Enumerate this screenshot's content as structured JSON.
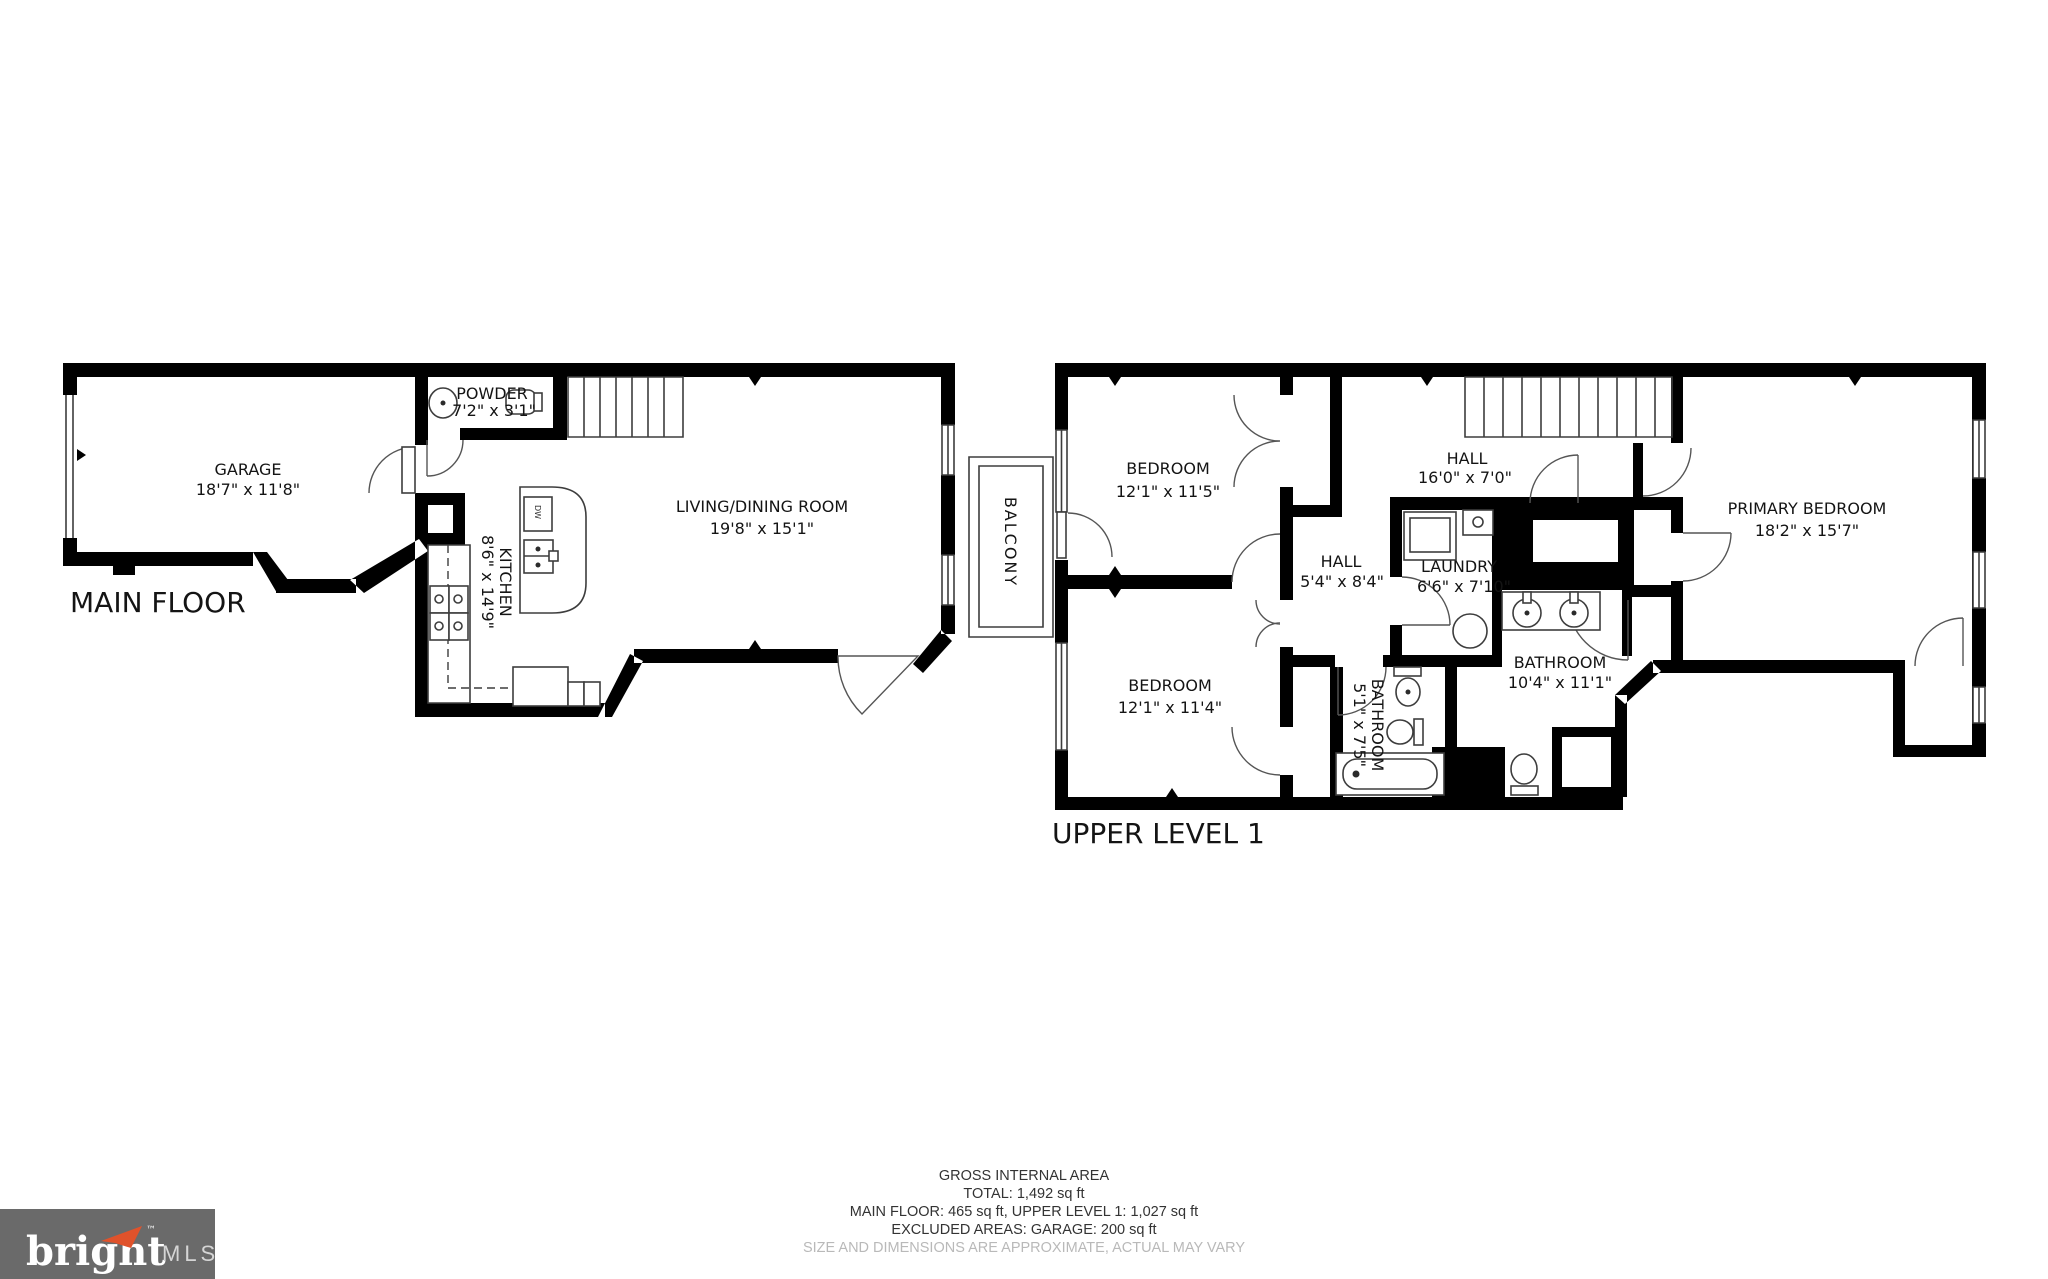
{
  "captions": {
    "main_floor": "MAIN FLOOR",
    "upper_level": "UPPER LEVEL 1"
  },
  "rooms": {
    "garage": {
      "name": "GARAGE",
      "dims": "18'7\" x 11'8\""
    },
    "powder": {
      "name": "POWDER",
      "dims": "7'2\" x 3'1\""
    },
    "kitchen": {
      "name": "KITCHEN",
      "dims": "8'6\" x 14'9\""
    },
    "living": {
      "name": "LIVING/DINING ROOM",
      "dims": "19'8\" x 15'1\""
    },
    "balcony": {
      "name": "BALCONY"
    },
    "bedroom1": {
      "name": "BEDROOM",
      "dims": "12'1\" x 11'5\""
    },
    "bedroom2": {
      "name": "BEDROOM",
      "dims": "12'1\" x 11'4\""
    },
    "hall_upper": {
      "name": "HALL",
      "dims": "16'0\" x 7'0\""
    },
    "hall_lower": {
      "name": "HALL",
      "dims": "5'4\" x 8'4\""
    },
    "laundry": {
      "name": "LAUNDRY",
      "dims": "6'6\" x 7'10\""
    },
    "bathroom_small": {
      "name": "BATHROOM",
      "dims": "5'1\" x 7'5\""
    },
    "bathroom_main": {
      "name": "BATHROOM",
      "dims": "10'4\" x 11'1\""
    },
    "primary": {
      "name": "PRIMARY BEDROOM",
      "dims": "18'2\" x 15'7\""
    }
  },
  "fixtures": {
    "dishwasher_label": "DW"
  },
  "summary": {
    "line1": "GROSS INTERNAL AREA",
    "line2": "TOTAL: 1,492 sq ft",
    "line3": "MAIN FLOOR: 465 sq ft, UPPER LEVEL 1: 1,027 sq ft",
    "line4": "EXCLUDED AREAS: GARAGE: 200 sq ft",
    "disclaimer": "SIZE AND DIMENSIONS ARE APPROXIMATE, ACTUAL MAY VARY"
  },
  "logo": {
    "brand": "bright",
    "tm": "™",
    "suffix": "MLS"
  },
  "colors": {
    "walls": "#000000",
    "label_text": "#141414",
    "summary_text": "#333333",
    "disclaimer_text": "#b9b9b9",
    "logo_background": "#6a6a6a",
    "logo_brand_text": "#ffffff",
    "logo_mls_text": "#d5d5d5",
    "logo_accent": "#e0522b"
  }
}
